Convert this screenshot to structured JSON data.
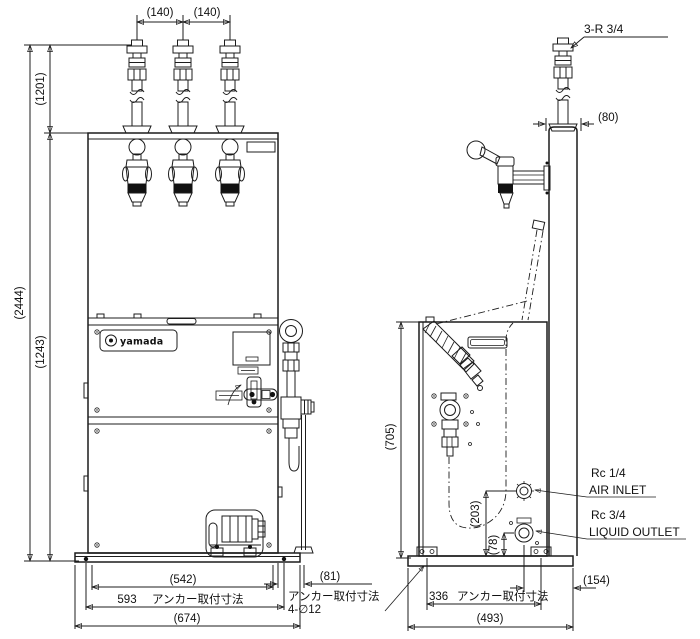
{
  "drawing": {
    "logo": "yamada",
    "front_view": {
      "pitch_left": "(140)",
      "pitch_right": "(140)",
      "height_upper": "(1201)",
      "height_total": "(2444)",
      "height_cabinet": "(1243)",
      "base_inner_width": "(542)",
      "anchor_pitch_value": "593",
      "anchor_pitch_label": "アンカー取付寸法",
      "base_width": "(674)",
      "pipe_offset": "(81)"
    },
    "side_view": {
      "riser_thread": "3-R 3/4",
      "riser_width": "(80)",
      "body_height": "(705)",
      "air_inlet_height": "(203)",
      "outlet_height": "(78)",
      "outlet_offset": "(154)",
      "anchor_pitch_value": "336",
      "anchor_pitch_label": "アンカー取付寸法",
      "base_depth": "(493)",
      "air_inlet_thread": "Rc 1/4",
      "air_inlet_label": "AIR INLET",
      "liquid_outlet_thread": "Rc 3/4",
      "liquid_outlet_label": "LIQUID OUTLET"
    },
    "note": {
      "line1": "アンカー取付寸法",
      "line2": "4-∅12"
    }
  }
}
